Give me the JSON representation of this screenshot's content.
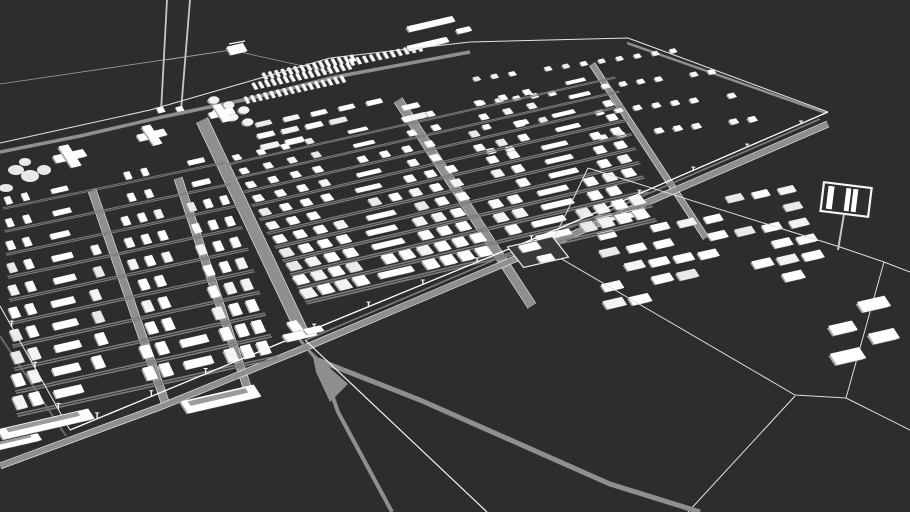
{
  "meta": {
    "label": "3D architectural site model of a large barracks camp complex, white buildings on dark ground"
  },
  "colors": {
    "background": "#2d2d2d",
    "building_top": "#ffffff",
    "building_top_alt1": "#f3f3f3",
    "building_top_alt2": "#e9e9e9",
    "building_side": "#a9a9a9",
    "road": "#8f8f8f",
    "road_edge": "#d8d8d8",
    "street": "#7d7d7d",
    "fence": "#ececec",
    "fence_bright": "#ffffff",
    "wire": "#9b9b9b",
    "pole": "#c6c6c6",
    "compound_fill": "#3a3a3a",
    "platform_inner": "#9c9c9c"
  },
  "axes": {
    "u": [
      0.9745,
      -0.2245
    ]
  },
  "sectors": [
    {
      "name": "sector-barracks-northeast",
      "v": [
        0.62,
        0.79
      ],
      "rows": 4,
      "bottom": {
        "start": [
          482,
          152
        ],
        "end": [
          762,
          118
        ]
      },
      "top": {
        "start": [
          468,
          80
        ],
        "end": [
          700,
          47
        ]
      },
      "count": [
        15,
        13
      ],
      "bw": 6.5,
      "bl": 5,
      "far_scale": 0.8,
      "skip": 0.28,
      "street": false
    },
    {
      "name": "sector-slab-row-upper",
      "axis": "u",
      "v": [
        0.55,
        0.84
      ],
      "rows": 3,
      "bottom": {
        "start": [
          258,
          148
        ],
        "end": [
          430,
          114
        ]
      },
      "top": {
        "start": [
          250,
          126
        ],
        "end": [
          416,
          94
        ]
      },
      "count": [
        7,
        6
      ],
      "bw": 17,
      "bl": 5,
      "far_scale": 0.85,
      "skip": 0.18,
      "street": false
    },
    {
      "name": "sector-barracks-east",
      "axis": "u",
      "v": [
        0.55,
        0.84
      ],
      "rows": 6,
      "bottom": {
        "start": [
          602,
          305
        ],
        "end": [
          832,
          270
        ]
      },
      "top": {
        "start": [
          592,
          220
        ],
        "end": [
          800,
          188
        ]
      },
      "count": [
        9,
        8
      ],
      "bw": 19,
      "bl": 8.5,
      "far_scale": 0.8,
      "skip": 0.3,
      "street": false
    },
    {
      "name": "sector-barracks-center",
      "v": [
        0.62,
        0.79
      ],
      "rows": 11,
      "bottom": {
        "start": [
          300,
          295
        ],
        "end": [
          650,
          212
        ]
      },
      "top": {
        "start": [
          225,
          160
        ],
        "end": [
          612,
          73
        ]
      },
      "count": [
        20,
        16
      ],
      "bw": 11.5,
      "bl": 10,
      "far_scale": 0.56,
      "gaps": [
        [
          0.54,
          0.6
        ]
      ],
      "skip": 0.05,
      "long_every": 9,
      "long_off": 4,
      "street": true
    },
    {
      "name": "sector-barracks-left",
      "v": [
        0.42,
        0.91
      ],
      "rows": 10,
      "bottom": {
        "start": [
          12,
          404
        ],
        "end": [
          272,
          346
        ]
      },
      "top": {
        "start": [
          0,
          202
        ],
        "end": [
          222,
          156
        ]
      },
      "count": [
        16,
        13
      ],
      "bw": 9.5,
      "bl": 13,
      "far_scale": 0.58,
      "gaps": [
        [
          0.4,
          0.5
        ],
        [
          0.7,
          0.79
        ]
      ],
      "skip": 0.06,
      "long_every": 8,
      "long_off": 2,
      "street": true
    }
  ],
  "roads": [
    {
      "name": "road-north-perimeter",
      "pts": [
        [
          0,
          152
        ],
        [
          80,
          136
        ],
        [
          162,
          117
        ],
        [
          248,
          99
        ],
        [
          335,
          77
        ],
        [
          470,
          52
        ]
      ],
      "w": 3.5
    },
    {
      "name": "road-northeast-perimeter",
      "pts": [
        [
          627,
          43
        ],
        [
          826,
          113
        ]
      ],
      "w": 2.5
    },
    {
      "name": "road-sector-divider",
      "pts": [
        [
          202,
          120
        ],
        [
          305,
          338
        ]
      ],
      "w": 11,
      "edges": true
    },
    {
      "name": "road-left-internal-1",
      "pts": [
        [
          92,
          190
        ],
        [
          165,
          402
        ]
      ],
      "w": 7,
      "edges": true
    },
    {
      "name": "road-left-internal-2",
      "pts": [
        [
          178,
          178
        ],
        [
          248,
          390
        ]
      ],
      "w": 7,
      "edges": true
    },
    {
      "name": "road-center-cross-1",
      "pts": [
        [
          398,
          100
        ],
        [
          532,
          306
        ]
      ],
      "w": 8,
      "edges": true
    },
    {
      "name": "road-center-cross-2",
      "pts": [
        [
          592,
          64
        ],
        [
          706,
          238
        ]
      ],
      "w": 5,
      "edges": true
    },
    {
      "name": "road-ramp-rail",
      "pts": [
        [
          306,
          340
        ],
        [
          560,
          232
        ],
        [
          820,
          119
        ]
      ],
      "w": 1.6,
      "color": "#7e7e7e"
    },
    {
      "name": "road-outer-west",
      "pts": [
        [
          0,
          336
        ],
        [
          66,
          436
        ]
      ],
      "w": 2,
      "color": "#6a6a6a"
    },
    {
      "name": "road-south-main",
      "pts": [
        [
          0,
          466
        ],
        [
          160,
          407
        ],
        [
          302,
          349
        ],
        [
          560,
          240
        ],
        [
          828,
          124
        ]
      ],
      "w": 5,
      "edges": true
    }
  ],
  "rails": {
    "gate_stub": {
      "pts": [
        [
          300,
          340
        ],
        [
          322,
          366
        ]
      ],
      "w": 3
    },
    "wedge": [
      [
        312,
        352
      ],
      [
        348,
        384
      ],
      [
        330,
        402
      ],
      [
        316,
        372
      ]
    ],
    "branch_right": {
      "pts": [
        [
          318,
          360
        ],
        [
          420,
          400
        ],
        [
          610,
          484
        ],
        [
          700,
          512
        ]
      ],
      "w": 5
    },
    "branch_down": {
      "pts": [
        [
          322,
          366
        ],
        [
          338,
          412
        ],
        [
          392,
          512
        ]
      ],
      "w": 4
    },
    "spur_line": {
      "pts": [
        [
          305,
          340
        ],
        [
          487,
          512
        ]
      ],
      "w": 1.2,
      "color": "#f4f4f4"
    }
  },
  "fences": [
    {
      "name": "fence-north",
      "pts": [
        [
          0,
          143
        ],
        [
          150,
          110
        ],
        [
          240,
          84
        ],
        [
          330,
          58
        ],
        [
          470,
          42
        ],
        [
          628,
          38
        ],
        [
          828,
          112
        ]
      ],
      "w": 1,
      "color": "#e4e4e4"
    },
    {
      "name": "fence-south-main",
      "pts": [
        [
          828,
          112
        ],
        [
          560,
          228
        ],
        [
          302,
          334
        ],
        [
          70,
          430
        ]
      ],
      "w": 1.3,
      "color": "#ffffff",
      "posts": 14,
      "post_size": [
        3,
        6.5
      ]
    },
    {
      "name": "fence-west",
      "pts": [
        [
          70,
          430
        ],
        [
          0,
          306
        ]
      ],
      "w": 1,
      "color": "#f0f0f0",
      "posts": 3,
      "post_size": [
        6.5,
        6
      ]
    },
    {
      "name": "fence-east-compound",
      "pts": [
        [
          588,
          168
        ],
        [
          840,
          247
        ],
        [
          884,
          262
        ],
        [
          846,
          398
        ],
        [
          795,
          395
        ],
        [
          548,
          251
        ],
        [
          588,
          168
        ]
      ],
      "w": 1,
      "color": "#dedede"
    },
    {
      "name": "fence-exit-right-upper",
      "pts": [
        [
          884,
          262
        ],
        [
          910,
          272
        ]
      ],
      "w": 1,
      "color": "#dedede"
    },
    {
      "name": "fence-exit-right-lower",
      "pts": [
        [
          846,
          398
        ],
        [
          910,
          430
        ]
      ],
      "w": 1,
      "color": "#dedede"
    },
    {
      "name": "fence-exit-south",
      "pts": [
        [
          795,
          396
        ],
        [
          688,
          512
        ]
      ],
      "w": 1,
      "color": "#e8e8e8"
    }
  ],
  "wires": [
    [
      [
        0,
        84
      ],
      [
        231,
        50
      ]
    ],
    [
      [
        231,
        50
      ],
      [
        330,
        72
      ]
    ],
    [
      [
        166,
        60
      ],
      [
        231,
        50
      ]
    ]
  ],
  "poles": {
    "lines": [
      [
        [
          167,
          0
        ],
        [
          161,
          112
        ]
      ],
      [
        [
          190,
          0
        ],
        [
          181,
          111
        ]
      ]
    ],
    "bases": [
      [
        161,
        110
      ],
      [
        180,
        109
      ]
    ]
  },
  "landmarks": {
    "crosses": [
      {
        "c": [
          70,
          156
        ],
        "s": 1.0
      },
      {
        "c": [
          152,
          135
        ],
        "s": 0.9
      },
      {
        "c": [
          222,
          113
        ],
        "s": 0.8
      }
    ],
    "grove": [
      [
        16,
        170,
        8,
        5
      ],
      [
        30,
        176,
        9,
        6
      ],
      [
        44,
        170,
        7,
        5
      ],
      [
        25,
        162,
        6,
        4
      ],
      [
        6,
        188,
        7,
        4
      ]
    ],
    "tanks": {
      "centers": [
        [
          214,
          100
        ],
        [
          229,
          105
        ],
        [
          244,
          110
        ],
        [
          218,
          112
        ],
        [
          233,
          117
        ],
        [
          248,
          122
        ]
      ],
      "rx": 5.5,
      "ry": 3.8
    },
    "house": {
      "c": [
        237,
        49
      ]
    },
    "strips": [
      {
        "a": [
          247,
          100
        ],
        "b": [
          343,
          79
        ],
        "n": 16
      },
      {
        "a": [
          255,
          86
        ],
        "b": [
          349,
          66
        ],
        "n": 16
      },
      {
        "a": [
          265,
          76
        ],
        "b": [
          353,
          58
        ],
        "n": 15
      },
      {
        "a": [
          352,
          62
        ],
        "b": [
          420,
          48
        ],
        "n": 11
      }
    ],
    "float_bars": [
      {
        "c": [
          431,
          24
        ],
        "w": 46,
        "l": 5.5
      },
      {
        "c": [
          464,
          30
        ],
        "w": 13,
        "l": 4.5
      },
      {
        "c": [
          428,
          44
        ],
        "w": 40,
        "l": 5
      }
    ],
    "platforms": [
      {
        "c": [
          46,
          424
        ],
        "w": 92,
        "l": 11
      },
      {
        "c": [
          221,
          399
        ],
        "w": 74,
        "l": 13
      },
      {
        "c": [
          12,
          443
        ],
        "w": 56,
        "l": 7
      }
    ],
    "gatehouse": {
      "parts": [
        {
          "c": [
            300,
            335
          ],
          "w": 30,
          "l": 8
        },
        {
          "c": [
            314,
            330
          ],
          "w": 16,
          "l": 6
        },
        {
          "c": [
            295,
            326
          ],
          "w": 9,
          "l": 11
        }
      ]
    },
    "compound": {
      "c": [
        538,
        252
      ],
      "w": 46,
      "l": 26
    },
    "billboard": {
      "board": [
        822,
        185,
        48,
        29
      ],
      "rotate": 7,
      "cx": 846,
      "cy": 200,
      "bars": [
        [
          827,
          188,
          6,
          23
        ],
        [
          845,
          188,
          5,
          23
        ],
        [
          852,
          188,
          5,
          23
        ]
      ],
      "pole": [
        [
          844,
          214
        ],
        [
          838,
          250
        ]
      ]
    },
    "cluster": [
      {
        "c": [
          874,
          304
        ],
        "w": 27,
        "l": 11
      },
      {
        "c": [
          843,
          328
        ],
        "w": 23,
        "l": 10
      },
      {
        "c": [
          884,
          336
        ],
        "w": 25,
        "l": 11
      },
      {
        "c": [
          848,
          356
        ],
        "w": 29,
        "l": 12
      }
    ]
  }
}
